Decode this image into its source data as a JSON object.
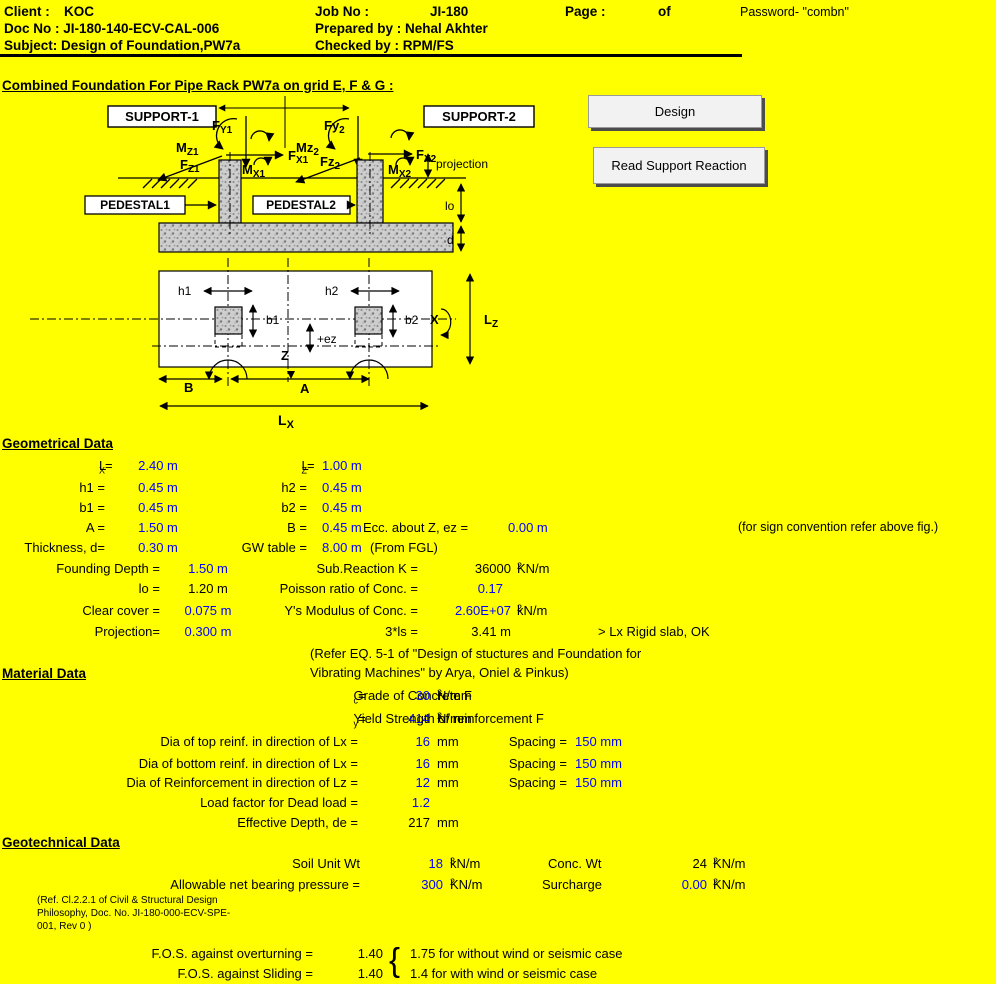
{
  "header": {
    "client_label": "Client :",
    "client": "KOC",
    "job_label": "Job No :",
    "job": "JI-180",
    "page_label": "Page :",
    "of": "of",
    "password": "Password- \"combn\"",
    "doc": "Doc No : JI-180-140-ECV-CAL-006",
    "prepared": "Prepared by : Nehal Akhter",
    "subject": "Subject: Design of Foundation,PW7a",
    "checked": "Checked by : RPM/FS"
  },
  "title": "Combined Foundation For Pipe Rack PW7a on grid E, F & G :",
  "buttons": {
    "design": "Design",
    "read": "Read Support Reaction"
  },
  "diagram": {
    "support1": "SUPPORT-1",
    "support2": "SUPPORT-2",
    "pedestal1": "PEDESTAL1",
    "pedestal2": "PEDESTAL2",
    "projection": "projection",
    "lo": "lo",
    "d": "d",
    "h1": "h1",
    "h2": "h2",
    "b1": "b1",
    "b2": "b2",
    "ez": "+ez",
    "x": "X",
    "z": "Z",
    "a": "A",
    "b": "B",
    "lz": {
      "p": "L",
      "s": "Z"
    },
    "lx": {
      "p": "L",
      "s": "X"
    },
    "f1": {
      "p": "F",
      "s": "Y1"
    },
    "m1": {
      "p": "M",
      "s": "Z1"
    },
    "fx1": {
      "p": "F",
      "s": "X1"
    },
    "fz1": {
      "p": "F",
      "s": "Z1"
    },
    "mx1": {
      "p": "M",
      "s": "X1"
    },
    "f2": {
      "p": "Fy",
      "s": "2"
    },
    "m2": {
      "p": "Mz",
      "s": "2"
    },
    "fx2": {
      "p": "F",
      "s": "X2"
    },
    "fz2": {
      "p": "Fz",
      "s": "2"
    },
    "mx2": {
      "p": "M",
      "s": "X2"
    }
  },
  "geo": {
    "heading": "Geometrical Data",
    "r1": {
      "l1p": "L",
      "l1s": "X",
      "l1t": " =",
      "v1": "2.40 m",
      "l2p": "L",
      "l2s": "Z",
      "l2t": " =",
      "v2": "1.00 m"
    },
    "r2": {
      "l1": "h1 =",
      "v1": "0.45 m",
      "l2": "h2 =",
      "v2": "0.45 m"
    },
    "r3": {
      "l1": "b1 =",
      "v1": "0.45 m",
      "l2": "b2 =",
      "v2": "0.45 m"
    },
    "r4": {
      "l1": "A =",
      "v1": "1.50 m",
      "l2": "B =",
      "v2": "0.45 m",
      "l3": "Ecc. about Z, ez =",
      "v3": "0.00 m",
      "note": "(for sign convention refer above fig.)"
    },
    "r5": {
      "l1": "Thickness, d=",
      "v1": "0.30 m",
      "l2": "GW table =",
      "v2": "8.00 m",
      "note": "(From FGL)"
    },
    "r6": {
      "l1": "Founding Depth =",
      "v1": "1.50 m",
      "l2": "Sub.Reaction K =",
      "v2": "36000",
      "u2": "KN/m",
      "sup2": "2"
    },
    "r7": {
      "l1": "lo =",
      "v1": "1.20 m",
      "l2": "Poisson ratio of Conc. =",
      "v2": "0.17"
    },
    "r8": {
      "l1": "Clear cover =",
      "v1": "0.075 m",
      "l2": "Y's Modulus of Conc. =",
      "v2": "2.60E+07",
      "u2": "kN/m",
      "sup2": "2"
    },
    "r9": {
      "l1": "Projection=",
      "v1": "0.300 m",
      "l2": "3*ls =",
      "v2": "3.41 m",
      "note": "> Lx Rigid slab, OK"
    },
    "note1": "(Refer EQ. 5-1 of \"Design of stuctures and Foundation for",
    "note2": "Vibrating Machines\" by Arya, Oniel & Pinkus)"
  },
  "mat": {
    "heading": "Material Data",
    "r1": {
      "lp": "Grade of Concrete F",
      "ls": "c",
      "lt": " =",
      "v": "30",
      "u": "N/mm",
      "sup": "2"
    },
    "r2": {
      "lp": "Yield Strength of reinforcement  F",
      "ls": "y",
      "lt": "=",
      "v": "414",
      "u": "N/mm",
      "sup": "2"
    },
    "r3": {
      "l": "Dia of top reinf. in direction of Lx =",
      "v": "16",
      "u": "mm",
      "l2": "Spacing =",
      "v2": "150 mm"
    },
    "r4": {
      "l": "Dia of bottom reinf. in direction of Lx =",
      "v": "16",
      "u": "mm",
      "l2": "Spacing =",
      "v2": "150 mm"
    },
    "r5": {
      "l": "Dia of Reinforcement in direction of Lz =",
      "v": "12",
      "u": "mm",
      "l2": "Spacing =",
      "v2": "150 mm"
    },
    "r6": {
      "l": "Load factor for Dead load =",
      "v": "1.2"
    },
    "r7": {
      "l": "Effective Depth, de =",
      "v": "217",
      "u": "mm"
    }
  },
  "geot": {
    "heading": "Geotechnical Data",
    "r1": {
      "l": "Soil Unit Wt",
      "v": "18",
      "u": "kN/m",
      "sup": "3",
      "l2": "Conc. Wt",
      "v2": "24",
      "u2": "KN/m",
      "sup2": "2"
    },
    "r2": {
      "l": "Allowable net bearing pressure =",
      "v": "300",
      "u": "KN/m",
      "sup": "2",
      "l2": "Surcharge",
      "v2": "0.00",
      "u2": "KN/m",
      "sup2": "2"
    },
    "ref1": "(Ref. Cl.2.2.1 of Civil & Structural Design",
    "ref2": "Philosophy, Doc. No. JI-180-000-ECV-SPE-",
    "ref3": "001, Rev 0 )",
    "brace": "{",
    "r3": {
      "l": "F.O.S. against overturning =",
      "v": "1.40",
      "note": "1.75 for without wind or seismic case"
    },
    "r4": {
      "l": "F.O.S. against Sliding =",
      "v": "1.40",
      "note": "1.4 for with wind or seismic case"
    }
  }
}
